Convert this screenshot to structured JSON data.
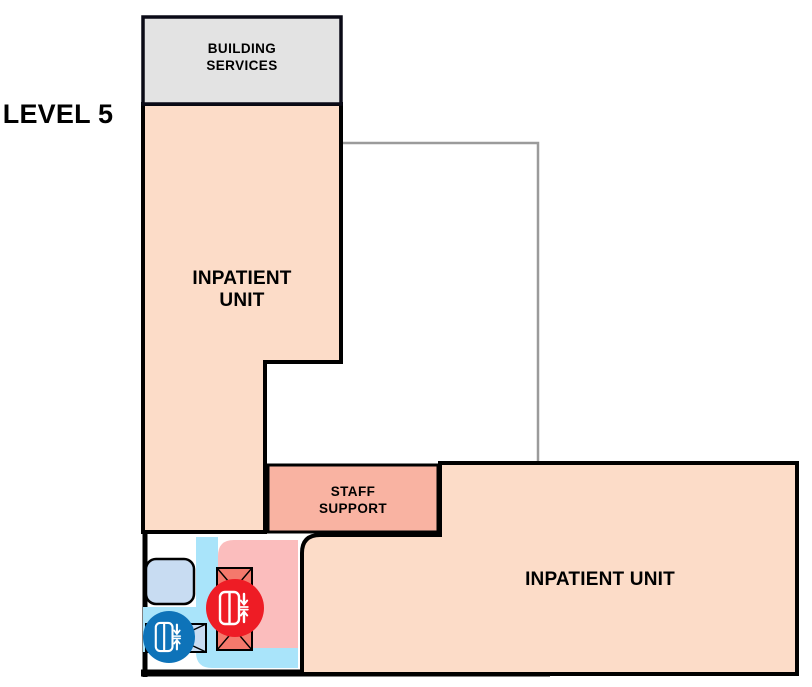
{
  "title": "LEVEL 5",
  "rooms": {
    "building_services": {
      "line1": "BUILDING",
      "line2": "SERVICES"
    },
    "inpatient_left": {
      "line1": "INPATIENT",
      "line2": "UNIT"
    },
    "staff_support": {
      "line1": "STAFF",
      "line2": "SUPPORT"
    },
    "inpatient_right": {
      "label": "INPATIENT UNIT"
    }
  },
  "icons": {
    "red_lift": "elevator-down-up-icon",
    "blue_lift": "elevator-down-up-icon"
  },
  "colors": {
    "unit_peach": "#FCDCC8",
    "services_gray": "#E3E3E3",
    "support_salmon": "#F9B3A2",
    "core_pink": "#FBBDBD",
    "corridor_cyan": "#A9E4FA",
    "room_light_blue": "#C8DCF2",
    "shaft_red": "#F4796C",
    "lift_red": "#EE1C25",
    "lift_blue": "#0E73B9",
    "outline_gray": "#9B9B9B",
    "wall_black": "#000000",
    "services_border": "#0A0A16"
  }
}
